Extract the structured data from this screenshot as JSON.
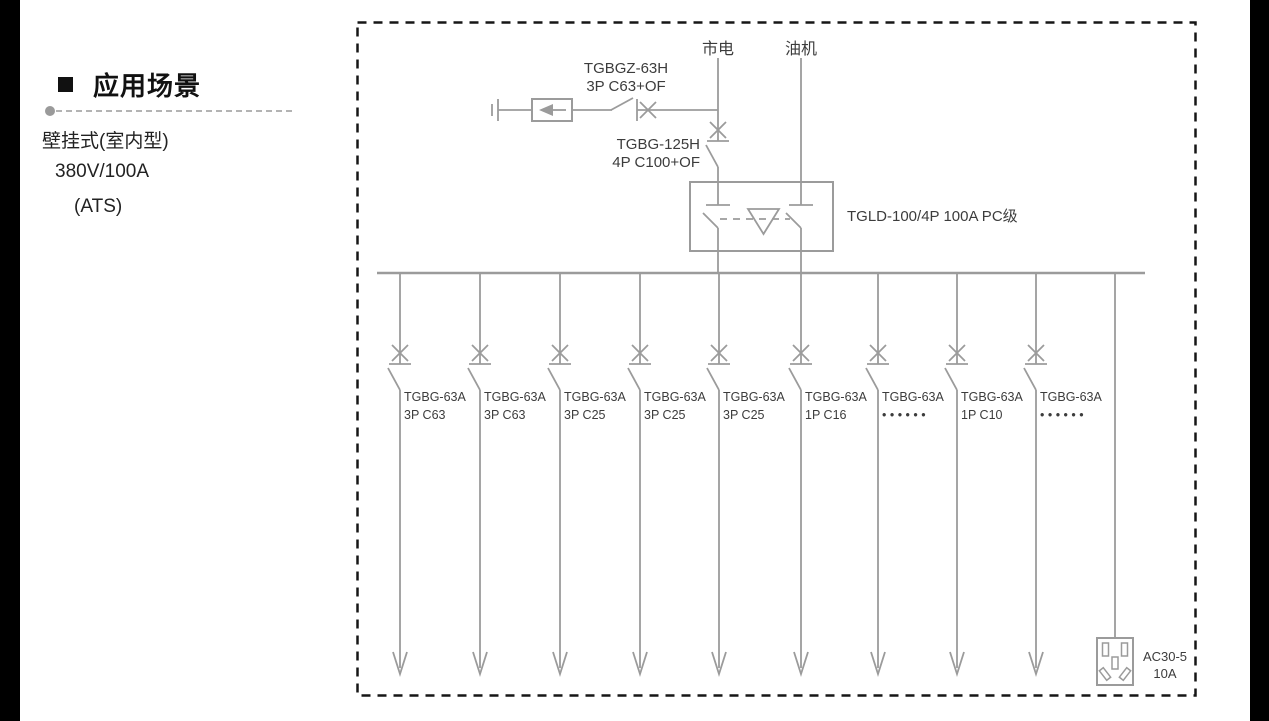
{
  "sidebar": {
    "bullet": "■",
    "heading": "应用场景",
    "lines": [
      "壁挂式(室内型)",
      "380V/100A",
      "(ATS)"
    ]
  },
  "diagram": {
    "colors": {
      "line": "#9b9b9b",
      "text": "#3c3c3c",
      "border": "#161616"
    },
    "sources": {
      "mains": "市电",
      "genset": "油机"
    },
    "spd_branch": {
      "breaker_model": "TGBGZ-63H",
      "breaker_spec": "3P C63+OF"
    },
    "main_breaker": {
      "model": "TGBG-125H",
      "spec": "4P C100+OF"
    },
    "ats": {
      "label": "TGLD-100/4P 100A PC级"
    },
    "branches": [
      {
        "model": "TGBG-63A",
        "spec": "3P C63"
      },
      {
        "model": "TGBG-63A",
        "spec": "3P C63"
      },
      {
        "model": "TGBG-63A",
        "spec": "3P C25"
      },
      {
        "model": "TGBG-63A",
        "spec": "3P C25"
      },
      {
        "model": "TGBG-63A",
        "spec": "3P C25"
      },
      {
        "model": "TGBG-63A",
        "spec": "1P C16"
      },
      {
        "model": "TGBG-63A",
        "spec": "• • • • • •"
      },
      {
        "model": "TGBG-63A",
        "spec": "1P C10"
      },
      {
        "model": "TGBG-63A",
        "spec": "• • • • • •"
      }
    ],
    "socket": {
      "label_line1": "AC30-5",
      "label_line2": "10A"
    }
  }
}
